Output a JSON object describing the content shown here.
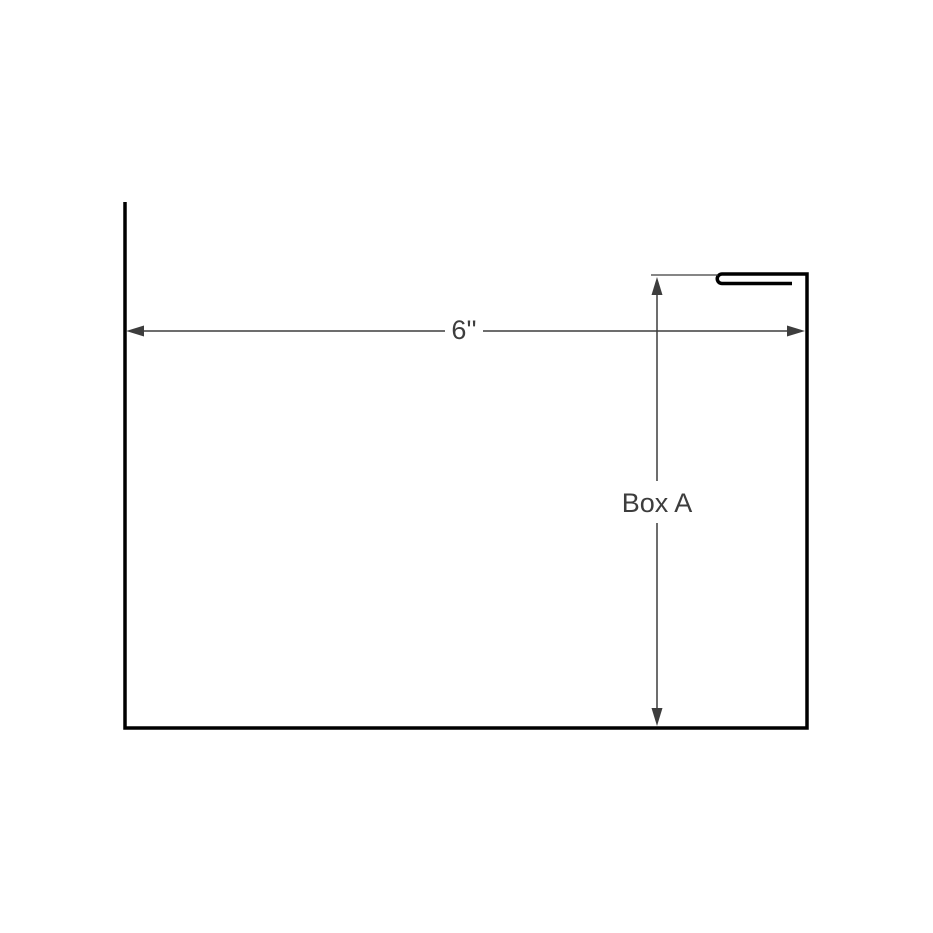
{
  "drawing": {
    "colors": {
      "background": "#ffffff",
      "profile_stroke": "#000000",
      "dimension_stroke": "#3d3d3d",
      "label_color": "#3d3d3d"
    },
    "labels": {
      "width_dimension": "6''",
      "height_dimension": "Box A"
    },
    "geometry": {
      "profile_path": "M 125 202 L 125 728 L 807 728 L 807 274 L 722 274 A 4.75 4.75 0 0 0 722 283.5 L 792 283.5",
      "extension_line_path": "M 651 275 L 718 275",
      "width_dimension_path": "M 143 331 L 445 331 M 483 331 L 788 331",
      "height_dimension_path": "M 657 294 L 657 481 M 657 523 L 657 710",
      "arrow_left_path": "M 126 331 L 144 325.5 L 144 336.5 Z",
      "arrow_right_path": "M 805 331 L 787 325.5 L 787 336.5 Z",
      "arrow_up_path": "M 657 277 L 651.5 295 L 662.5 295 Z",
      "arrow_down_path": "M 657 726 L 651.5 708 L 662.5 708 Z"
    }
  }
}
